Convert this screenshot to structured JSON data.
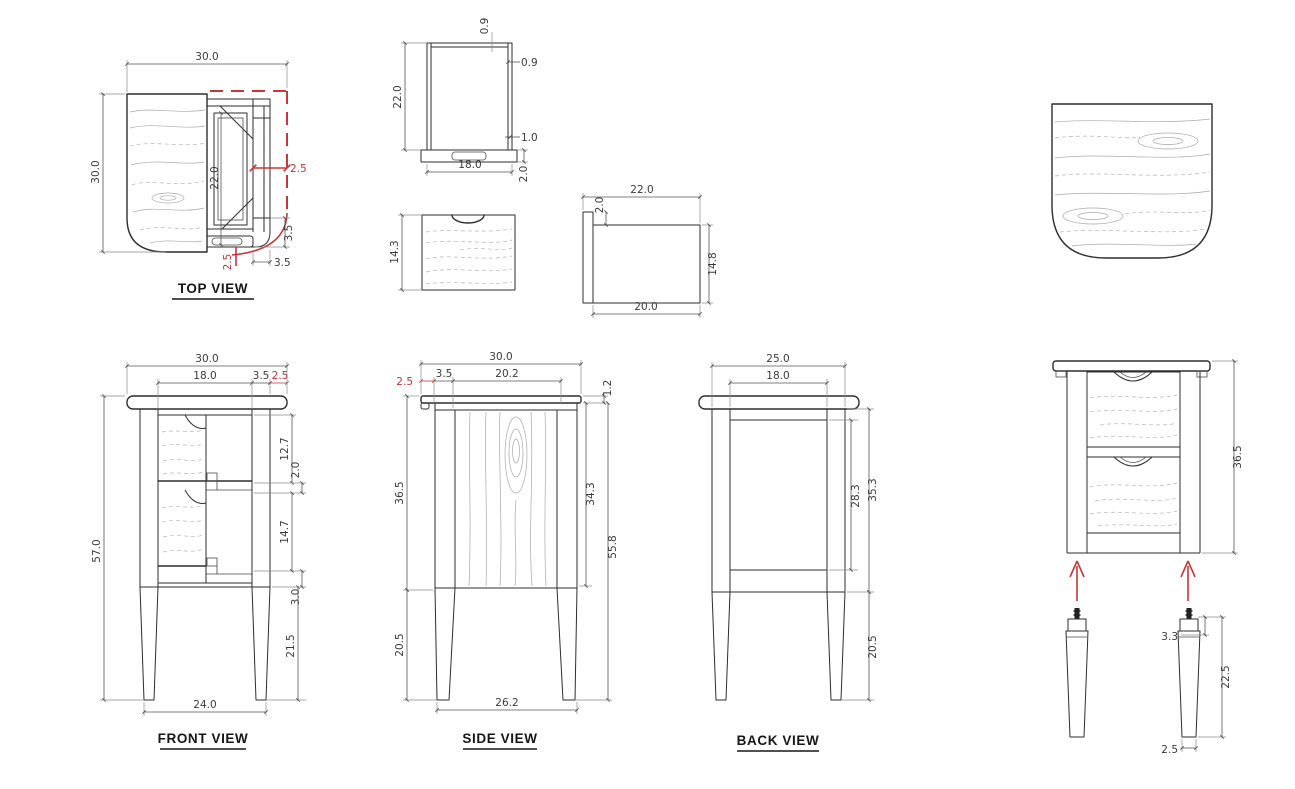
{
  "labels": {
    "top": "TOP VIEW",
    "front": "FRONT VIEW",
    "side": "SIDE VIEW",
    "back": "BACK VIEW"
  },
  "colors": {
    "line": "#2d2d2d",
    "dimension": "#555555",
    "highlight_red": "#c93636",
    "background": "#ffffff"
  },
  "views": {
    "top": {
      "dims": {
        "width": "30.0",
        "depth": "30.0",
        "opening_depth": "22.0",
        "side_rail_red": "2.5",
        "corner_radius_v": "3.5",
        "corner_radius_h": "3.5",
        "slide_offset_red": "2.5"
      }
    },
    "frame_detail": {
      "dims": {
        "height": "22.0",
        "top_rail": "0.9",
        "side_rail": "0.9",
        "lip": "1.0",
        "width": "18.0",
        "base": "2.0"
      }
    },
    "drawer_front_detail": {
      "dims": {
        "height": "14.3"
      }
    },
    "drawer_side_detail": {
      "dims": {
        "length": "22.0",
        "back_drop": "2.0",
        "height": "14.8",
        "bottom_length": "20.0"
      }
    },
    "front": {
      "dims": {
        "width": "30.0",
        "opening": "18.0",
        "stile": "3.5",
        "overhang_red": "2.5",
        "height": "57.0",
        "upper_drawer": "12.7",
        "mid_rail": "2.0",
        "lower_drawer": "14.7",
        "bottom_rail": "3.0",
        "leg": "21.5",
        "leg_span": "24.0"
      }
    },
    "side": {
      "dims": {
        "depth": "30.0",
        "overhang_red": "2.5",
        "leg_front": "3.5",
        "panel": "20.2",
        "top_thickness": "1.2",
        "body": "36.5",
        "panel_height": "34.3",
        "overall": "55.8",
        "leg": "20.5",
        "leg_span": "26.2"
      }
    },
    "back": {
      "dims": {
        "width": "25.0",
        "panel_width": "18.0",
        "panel_height": "28.3",
        "body": "35.3",
        "leg": "20.5"
      }
    },
    "assembly": {
      "dims": {
        "body": "36.5"
      }
    },
    "leg_detail": {
      "dims": {
        "top_section": "3.3",
        "length": "22.5",
        "foot": "2.5"
      }
    }
  }
}
